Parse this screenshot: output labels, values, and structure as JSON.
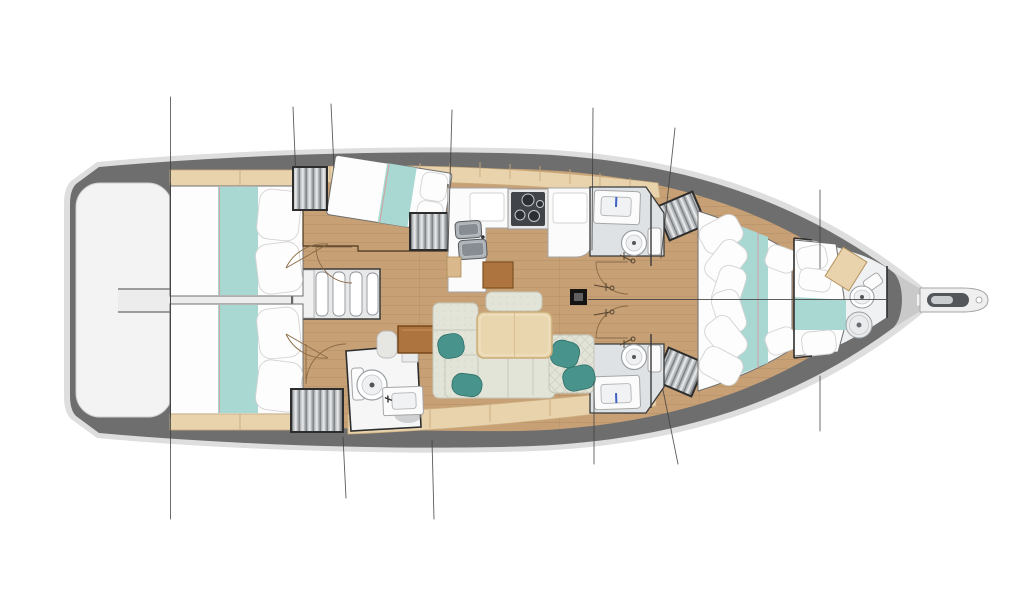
{
  "diagram": {
    "kind": "sailing-yacht-interior-layout-plan",
    "view": "top-down",
    "bow_direction": "right",
    "cabin_count": 4,
    "head_count": 4,
    "berth_count": 6,
    "legend": [
      "hull",
      "deck-band",
      "swim-platform",
      "aft-cabin-port",
      "aft-cabin-starboard",
      "companionway-stairs",
      "engine-corridor",
      "mid-cabin",
      "galley",
      "stove",
      "double-sink",
      "head-forward-port",
      "head-forward-starboard",
      "head-aft-starboard",
      "salon-sofa",
      "salon-table",
      "nav-desk",
      "forward-cabin-v-berth",
      "forepeak-cabin",
      "forepeak-head",
      "bowsprit",
      "mast",
      "rigging-lines",
      "door-swings"
    ]
  },
  "colors": {
    "page_bg": "#ffffff",
    "hull_rim": "#dedede",
    "deck_band": "#6e6e6e",
    "swim_platform": "#f3f3f3",
    "floor_wood": "#c7a076",
    "shelf_wood": "#e9d3ac",
    "bedding_white": "#fdfdfd",
    "bedding_teal": "#a9d8d3",
    "cushion_teal": "#48938b",
    "sofa_fabric": "#e2e4d8",
    "table_wood": "#ead6ae",
    "nav_desk_wood": "#ad7440",
    "fixture_white": "#fbfbfb",
    "head_floor": "#dfe2e4",
    "stove_panel": "#41454a",
    "sink_steel": "#aeb4b8",
    "louver_frame": "#2d2d2d",
    "line_color": "#3f3f3f",
    "door_arc": "#8a6a45",
    "mast_black": "#141414",
    "faucet_blue": "#3b62c4",
    "bow_wedge": "#c9c9c9"
  }
}
